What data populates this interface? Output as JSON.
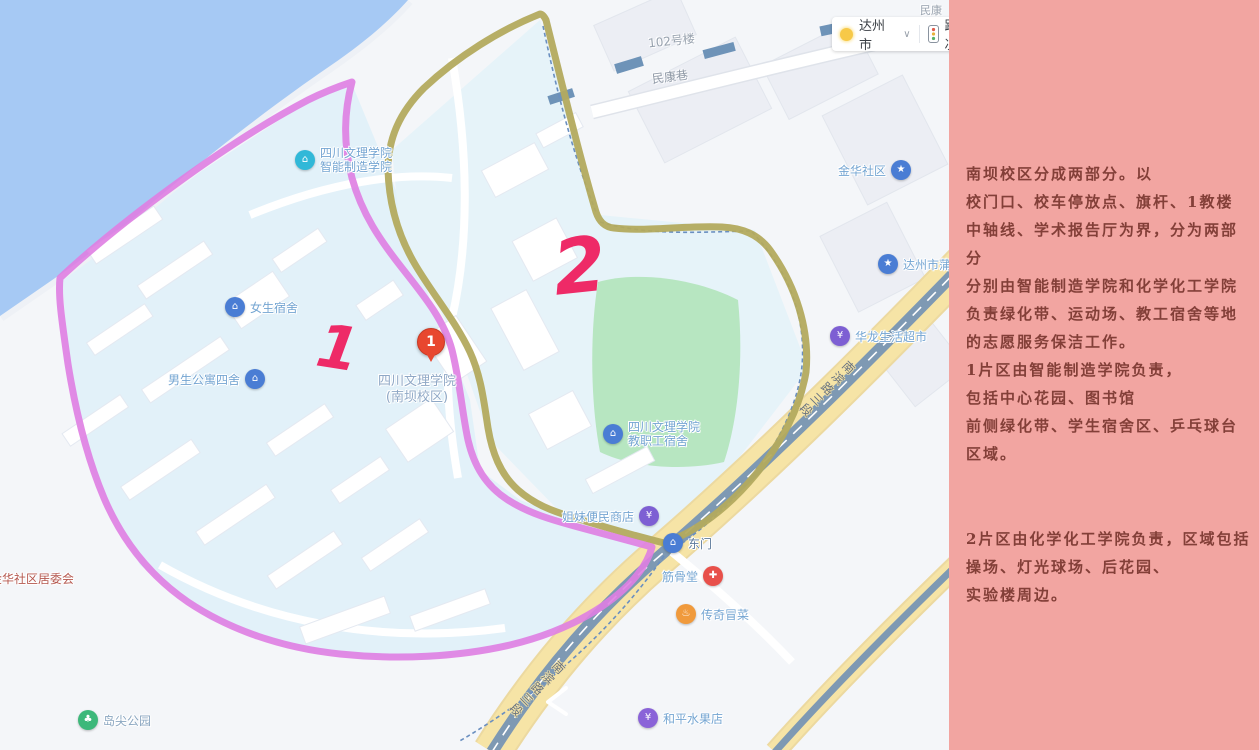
{
  "map": {
    "controls": {
      "city": "达州市",
      "caret": "∨",
      "traffic": "路况"
    },
    "roads": {
      "nanbin": "南滨路三段",
      "minkang_lane": "民康巷",
      "building_102": "102号楼",
      "minkang_partial": "民康"
    },
    "zones": {
      "marker1": "1",
      "marker2": "2"
    },
    "pois": {
      "zhineng": {
        "line1": "四川文理学院",
        "line2": "智能制造学院"
      },
      "nvsheng": {
        "label": "女生宿舍"
      },
      "nansheng": {
        "label": "男生公寓四舍"
      },
      "campus_pin": {
        "number": "1",
        "line1": "四川文理学院",
        "line2": "(南坝校区)"
      },
      "jiaogong": {
        "line1": "四川文理学院",
        "line2": "教职工宿舍"
      },
      "jiemei": {
        "label": "姐妹便民商店"
      },
      "dongmen": {
        "label": "东门"
      },
      "jingu": {
        "label": "筋骨堂"
      },
      "chuanqi": {
        "label": "传奇冒菜"
      },
      "heping": {
        "label": "和平水果店"
      },
      "daojian": {
        "label": "岛尖公园"
      },
      "jinhua_committee": {
        "label": "金华社区居委会"
      },
      "jinhua_shequ": {
        "label": "金华社区"
      },
      "dazhou_partial": {
        "label": "达州市蒲"
      },
      "hualong": {
        "label": "华龙生活超市"
      }
    },
    "icon_names": [
      "school-icon",
      "dorm-icon",
      "shop-icon",
      "gate-icon",
      "clinic-icon",
      "food-icon",
      "fruit-icon",
      "park-icon",
      "community-icon",
      "city-poi-icon",
      "sun-icon",
      "traffic-light-icon",
      "red-pin-icon"
    ]
  },
  "panel": {
    "lines": [
      "南坝校区分成两部分。以",
      "校门口、校车停放点、旗杆、1教楼",
      "中轴线、学术报告厅为界，分为两部分",
      "分别由智能制造学院和化学化工学院",
      "负责绿化带、运动场、教工宿舍等地",
      "的志愿服务保洁工作。",
      "1片区由智能制造学院负责，",
      "包括中心花园、图书馆",
      "前侧绿化带、学生宿舍区、乒乓球台",
      "区域。",
      "2片区由化学化工学院负责，区域包括",
      "操场、灯光球场、后花园、",
      "实验楼周边。"
    ]
  },
  "colors": {
    "panel_bg": "#f2a5a1",
    "panel_text": "#833f38",
    "zone1_outline": "#df7ee2",
    "zone2_outline": "#b3aa5e",
    "zone_number": "#ee2a67",
    "water": "#a6c9f4",
    "campus_fill": "#e2f1f9",
    "field_green": "#b7e6c1",
    "main_road": "#f6e4a6",
    "road_stripe": "#7e99b3"
  }
}
